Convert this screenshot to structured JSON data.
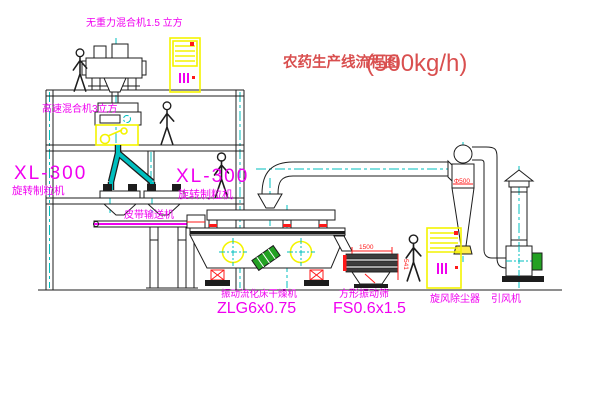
{
  "title": {
    "cn": "农药生产线流程图",
    "capacity": "(500kg/h)"
  },
  "labels": {
    "gravity_mixer": "无重力混合机1.5 立方",
    "high_speed_mixer": "高速混合机3立方",
    "granulator_left_model": "XL-300",
    "granulator_left_name": "旋转制粒机",
    "granulator_right_model": "XL-300",
    "granulator_right_name": "旋转制粒机",
    "belt_conveyor": "皮带输送机",
    "dryer_name": "振动流化床干燥机",
    "dryer_model": "ZLG6x0.75",
    "sieve_name": "方形振动筛",
    "sieve_model": "FS0.6x1.5",
    "cyclone": "旋风除尘器",
    "fan": "引风机"
  },
  "dimensions": {
    "sieve_length": "1500",
    "sieve_height": "541",
    "cyclone_dia": "Φ500"
  },
  "colors": {
    "dark": "#1d1d1d",
    "cyan": "#00bfbf",
    "yellow": "#f4f400",
    "red": "#ff1a1a",
    "magenta": "#f000f0",
    "title_red": "#d94f4f",
    "green": "#23a123"
  }
}
